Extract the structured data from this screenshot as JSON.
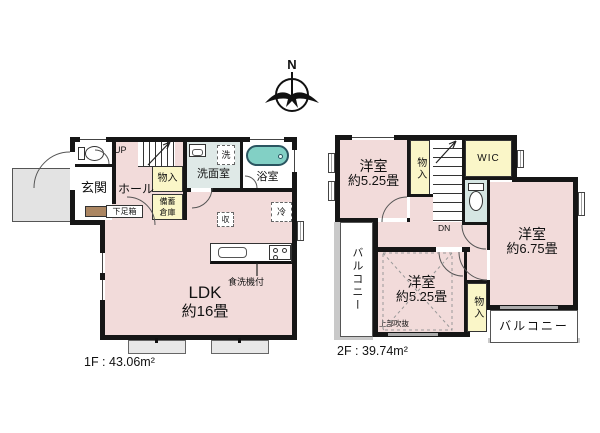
{
  "colors": {
    "wall": "#161616",
    "room_pink": "#f2dbda",
    "closet_yellow": "#faf6c8",
    "wet_blue": "#dfe9e7",
    "toilet_blue": "#d5e6e3",
    "tub_teal": "#82d0c5",
    "porch_gray": "#e3e3e3",
    "balcony_hatch": "#c9c9c9"
  },
  "compass": {
    "north_label": "N"
  },
  "floor1": {
    "area_label": "1F : 43.06m²",
    "genkan": "玄関",
    "hall": "ホール",
    "up": "UP",
    "shoe_box": "下足箱",
    "closet": "物入",
    "stock_line1": "備蓄",
    "stock_line2": "倉庫",
    "washroom": "洗面室",
    "washer": "洗",
    "bathroom": "浴室",
    "fridge": "冷",
    "storage": "収",
    "ldk_line1": "LDK",
    "ldk_line2": "約16畳",
    "dishwasher": "食洗機付"
  },
  "floor2": {
    "area_label": "2F : 39.74m²",
    "room_nw_line1": "洋室",
    "room_nw_line2": "約5.25畳",
    "closet_top": "物入",
    "dn": "DN",
    "wic": "WIC",
    "room_e_line1": "洋室",
    "room_e_line2": "約6.75畳",
    "room_s_line1": "洋室",
    "room_s_line2": "約5.25畳",
    "void_label": "上部吹抜",
    "closet_s": "物入",
    "balcony_left": "バルコニー",
    "balcony_right": "バルコニー"
  }
}
